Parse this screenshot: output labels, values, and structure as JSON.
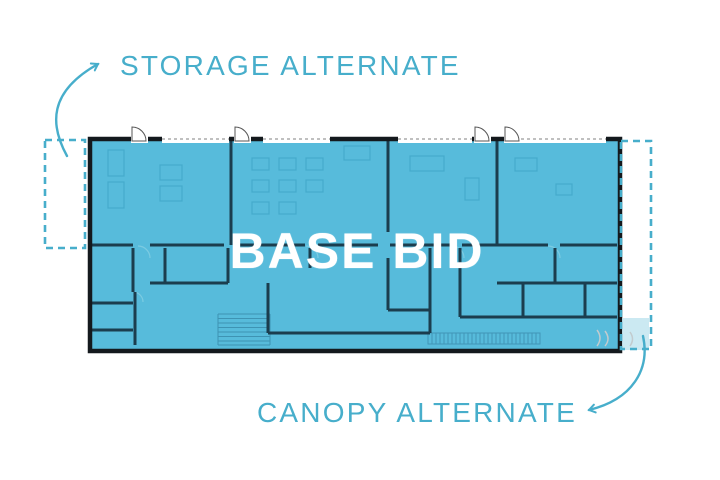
{
  "diagram": {
    "type": "architectural-floor-plan",
    "labels": {
      "storage": "STORAGE ALTERNATE",
      "canopy": "CANOPY ALTERNATE",
      "base_bid": "BASE BID"
    },
    "colors": {
      "accent_teal": "#47AECB",
      "plan_fill": "#57BBDB",
      "outer_wall": "#14191D",
      "interior_wall": "#1B3D4E",
      "base_bid_text": "#FFFFFF",
      "background": "#FFFFFF"
    },
    "regions": [
      {
        "name": "storage-alternate",
        "style": "dashed-outline"
      },
      {
        "name": "base-bid",
        "style": "solid-blue-fill"
      },
      {
        "name": "canopy-alternate",
        "style": "dashed-outline"
      }
    ]
  }
}
